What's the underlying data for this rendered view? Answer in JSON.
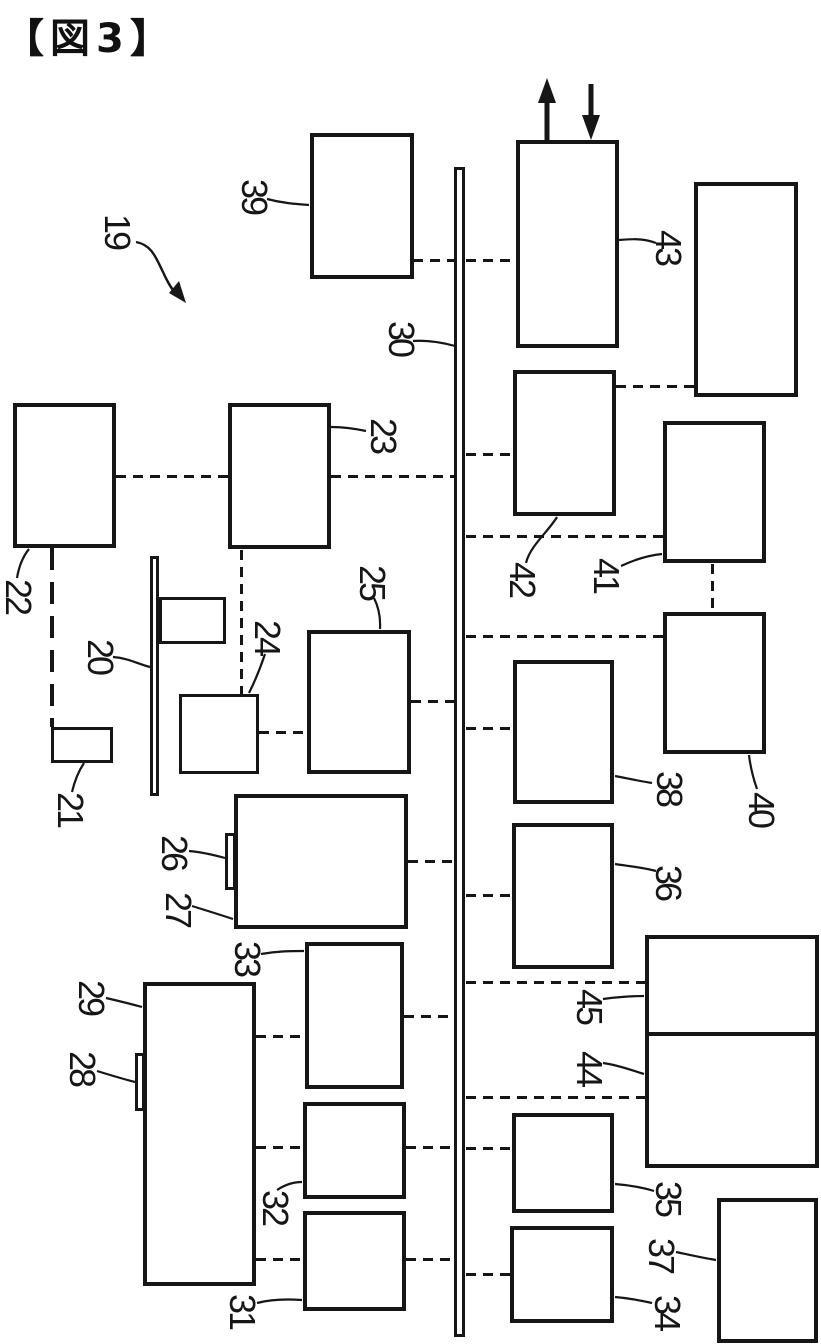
{
  "title": "【図3】",
  "figure": {
    "number": "3",
    "system_ref": "19",
    "bus_ref": "30",
    "component_refs": [
      "20",
      "21",
      "22",
      "23",
      "24",
      "25",
      "26",
      "27",
      "28",
      "29",
      "31",
      "32",
      "33",
      "34",
      "35",
      "36",
      "37",
      "38",
      "39",
      "40",
      "41",
      "42",
      "43",
      "44",
      "45"
    ],
    "unlabeled_blocks": 2,
    "line_color": "#161616",
    "background_color": "#ffffff",
    "notes": "Patent-style block diagram: numbered blocks connected by dashed lines to a central vertical bus (30); block 43 has one upward and one downward arrow; all reference numerals are rotated 90 degrees"
  },
  "labels": {
    "19": "19",
    "20": "20",
    "21": "21",
    "22": "22",
    "23": "23",
    "24": "24",
    "25": "25",
    "26": "26",
    "27": "27",
    "28": "28",
    "29": "29",
    "30": "30",
    "31": "31",
    "32": "32",
    "33": "33",
    "34": "34",
    "35": "35",
    "36": "36",
    "37": "37",
    "38": "38",
    "39": "39",
    "40": "40",
    "41": "41",
    "42": "42",
    "43": "43",
    "44": "44",
    "45": "45"
  }
}
